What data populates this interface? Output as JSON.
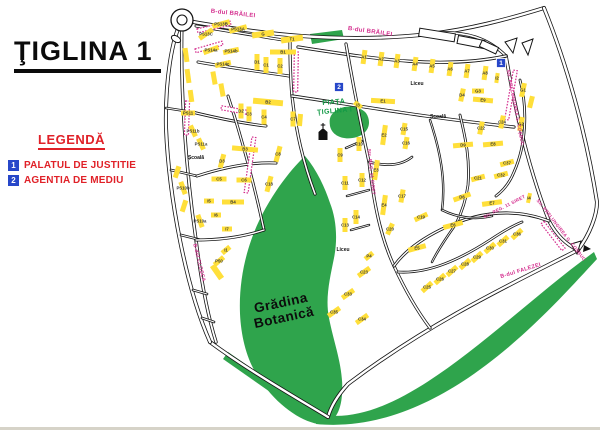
{
  "title": "ŢIGLINA 1",
  "legend": {
    "heading": "LEGENDĂ",
    "items": [
      {
        "num": "1",
        "label": "PALATUL DE JUSTITIE"
      },
      {
        "num": "2",
        "label": "AGENTIA DE MEDIU"
      }
    ]
  },
  "colors": {
    "block_yellow": "#ffdf3a",
    "park_green": "#2fa44c",
    "road_line": "#141414",
    "street_label_pink": "#d42e8e",
    "legend_red": "#e02128",
    "marker_blue": "#2747c9",
    "area_text_green": "#149a46",
    "block_label": "#3a3a3a"
  },
  "map": {
    "street_labels": [
      {
        "t": "B-dul BRĂILEI",
        "x": 233,
        "y": 15,
        "r": 6,
        "s": 6
      },
      {
        "t": "B-dul BRĂILEI",
        "x": 370,
        "y": 33,
        "r": 8,
        "s": 6
      },
      {
        "t": "Str. PRELUNGIREA G. COȘBUC",
        "x": 514,
        "y": 108,
        "r": 79,
        "s": 4.6
      },
      {
        "t": "Str. PRELUNGIREA G. COȘBUC",
        "x": 560,
        "y": 231,
        "r": 52,
        "s": 4.6
      },
      {
        "t": "B-dul FALEZEI",
        "x": 521,
        "y": 272,
        "r": -17,
        "s": 5.5
      },
      {
        "t": "B-dul CLOȘCA",
        "x": 198,
        "y": 263,
        "r": 76,
        "s": 5
      },
      {
        "t": "Str. REG. 11 SIRET",
        "x": 370,
        "y": 172,
        "r": 84,
        "s": 4.6
      },
      {
        "t": "Str. REG. 11 SIRET",
        "x": 505,
        "y": 208,
        "r": -27,
        "s": 4.6
      }
    ],
    "piata": {
      "lines": [
        "PIAŢA",
        "ŢIGLINA I"
      ]
    },
    "gradina": {
      "lines": [
        "Grădina",
        "Botanică"
      ]
    },
    "facility_labels": [
      {
        "t": "Școală",
        "x": 196,
        "y": 159
      },
      {
        "t": "Școală",
        "x": 438,
        "y": 118
      },
      {
        "t": "Liceu",
        "x": 417,
        "y": 85
      },
      {
        "t": "Liceu",
        "x": 343,
        "y": 251
      }
    ],
    "markers": [
      {
        "n": "1",
        "x": 501,
        "y": 63
      },
      {
        "n": "2",
        "x": 339,
        "y": 87
      }
    ],
    "church": {
      "x": 323,
      "y": 133
    },
    "blocks": [
      {
        "l": "PS13B",
        "x": 221,
        "y": 24,
        "w": 18,
        "h": 5,
        "r": -15
      },
      {
        "l": "PS13A",
        "x": 238,
        "y": 29,
        "w": 18,
        "h": 5,
        "r": -15
      },
      {
        "l": "PS13C",
        "x": 206,
        "y": 34,
        "w": 16,
        "h": 5,
        "r": -35
      },
      {
        "l": "PS14a",
        "x": 211,
        "y": 50,
        "w": 16,
        "h": 5,
        "r": -20
      },
      {
        "l": "PS14b",
        "x": 231,
        "y": 51,
        "w": 16,
        "h": 5,
        "r": -12
      },
      {
        "l": "PS14c",
        "x": 223,
        "y": 64,
        "w": 16,
        "h": 5,
        "r": -12
      },
      {
        "l": "G",
        "x": 263,
        "y": 34,
        "w": 22,
        "h": 6,
        "r": -8
      },
      {
        "l": "T1",
        "x": 292,
        "y": 39,
        "w": 22,
        "h": 6,
        "r": -8
      },
      {
        "l": "B1",
        "x": 283,
        "y": 52,
        "w": 26,
        "h": 5,
        "r": 0
      },
      {
        "l": "D1",
        "x": 257,
        "y": 62,
        "w": 5,
        "h": 16,
        "r": 0
      },
      {
        "l": "C1",
        "x": 266,
        "y": 65,
        "w": 5,
        "h": 16,
        "r": 0
      },
      {
        "l": "C2",
        "x": 280,
        "y": 66,
        "w": 5,
        "h": 16,
        "r": 0
      },
      {
        "l": "B2",
        "x": 268,
        "y": 102,
        "w": 30,
        "h": 6,
        "r": 5
      },
      {
        "l": "D2",
        "x": 241,
        "y": 111,
        "w": 5,
        "h": 15,
        "r": 0
      },
      {
        "l": "C3",
        "x": 249,
        "y": 114,
        "w": 5,
        "h": 15,
        "r": 0
      },
      {
        "l": "C4",
        "x": 264,
        "y": 117,
        "w": 5,
        "h": 15,
        "r": 0
      },
      {
        "l": "C7",
        "x": 293,
        "y": 119,
        "w": 5,
        "h": 15,
        "r": 0
      },
      {
        "l": "PS11",
        "x": 188,
        "y": 113,
        "w": 14,
        "h": 5,
        "r": 0
      },
      {
        "l": "PS11b",
        "x": 193,
        "y": 131,
        "w": 5,
        "h": 12,
        "r": -25
      },
      {
        "l": "PS11a",
        "x": 201,
        "y": 144,
        "w": 5,
        "h": 12,
        "r": -25
      },
      {
        "l": "B3",
        "x": 245,
        "y": 149,
        "w": 26,
        "h": 5,
        "r": 5
      },
      {
        "l": "D3",
        "x": 222,
        "y": 161,
        "w": 5,
        "h": 14,
        "r": 15
      },
      {
        "l": "C5",
        "x": 219,
        "y": 179,
        "w": 15,
        "h": 5,
        "r": 0
      },
      {
        "l": "C6",
        "x": 244,
        "y": 180,
        "w": 15,
        "h": 5,
        "r": 0
      },
      {
        "l": "C8",
        "x": 278,
        "y": 154,
        "w": 5,
        "h": 16,
        "r": 15
      },
      {
        "l": "C18",
        "x": 269,
        "y": 184,
        "w": 5,
        "h": 16,
        "r": 15
      },
      {
        "l": "I5",
        "x": 209,
        "y": 201,
        "w": 10,
        "h": 5,
        "r": 0
      },
      {
        "l": "B4",
        "x": 233,
        "y": 202,
        "w": 22,
        "h": 5,
        "r": 0
      },
      {
        "l": "I6",
        "x": 216,
        "y": 215,
        "w": 10,
        "h": 5,
        "r": 0
      },
      {
        "l": "I7",
        "x": 227,
        "y": 229,
        "w": 10,
        "h": 5,
        "r": 0
      },
      {
        "l": "PS10b",
        "x": 183,
        "y": 188,
        "w": 5,
        "h": 13,
        "r": -20
      },
      {
        "l": "PS10a",
        "x": 200,
        "y": 221,
        "w": 5,
        "h": 13,
        "r": -20
      },
      {
        "l": "I1",
        "x": 226,
        "y": 250,
        "w": 10,
        "h": 5,
        "r": -40
      },
      {
        "l": "P50",
        "x": 219,
        "y": 261,
        "w": 12,
        "h": 5,
        "r": -40
      },
      {
        "l": "A1",
        "x": 364,
        "y": 57,
        "w": 5,
        "h": 14,
        "r": 8
      },
      {
        "l": "A2",
        "x": 381,
        "y": 59,
        "w": 5,
        "h": 14,
        "r": 8
      },
      {
        "l": "A3",
        "x": 397,
        "y": 61,
        "w": 5,
        "h": 14,
        "r": 8
      },
      {
        "l": "A4",
        "x": 415,
        "y": 64,
        "w": 5,
        "h": 14,
        "r": 8
      },
      {
        "l": "A5",
        "x": 432,
        "y": 66,
        "w": 5,
        "h": 14,
        "r": 8
      },
      {
        "l": "A6",
        "x": 450,
        "y": 69,
        "w": 5,
        "h": 14,
        "r": 8
      },
      {
        "l": "A7",
        "x": 467,
        "y": 71,
        "w": 5,
        "h": 14,
        "r": 8
      },
      {
        "l": "A8",
        "x": 485,
        "y": 73,
        "w": 5,
        "h": 14,
        "r": 8
      },
      {
        "l": "I2",
        "x": 497,
        "y": 78,
        "w": 4,
        "h": 10,
        "r": 8
      },
      {
        "l": "G3",
        "x": 478,
        "y": 91,
        "w": 12,
        "h": 5,
        "r": 0
      },
      {
        "l": "D4",
        "x": 462,
        "y": 95,
        "w": 5,
        "h": 13,
        "r": 12
      },
      {
        "l": "E9",
        "x": 483,
        "y": 100,
        "w": 20,
        "h": 5,
        "r": 5
      },
      {
        "l": "G1",
        "x": 523,
        "y": 90,
        "w": 5,
        "h": 14,
        "r": 12
      },
      {
        "l": "G2",
        "x": 521,
        "y": 124,
        "w": 5,
        "h": 14,
        "r": 12
      },
      {
        "l": "C24",
        "x": 502,
        "y": 122,
        "w": 5,
        "h": 13,
        "r": 12
      },
      {
        "l": "C22",
        "x": 481,
        "y": 128,
        "w": 5,
        "h": 13,
        "r": 12
      },
      {
        "l": "E1",
        "x": 383,
        "y": 101,
        "w": 24,
        "h": 5,
        "r": 3
      },
      {
        "l": "I3",
        "x": 358,
        "y": 105,
        "w": 9,
        "h": 5,
        "r": 40
      },
      {
        "l": "C15",
        "x": 404,
        "y": 129,
        "w": 5,
        "h": 12,
        "r": 10
      },
      {
        "l": "C16",
        "x": 406,
        "y": 143,
        "w": 5,
        "h": 12,
        "r": 10
      },
      {
        "l": "C17",
        "x": 402,
        "y": 196,
        "w": 5,
        "h": 13,
        "r": 10
      },
      {
        "l": "E2",
        "x": 384,
        "y": 135,
        "w": 5,
        "h": 20,
        "r": 8
      },
      {
        "l": "E3",
        "x": 376,
        "y": 170,
        "w": 5,
        "h": 20,
        "r": 8
      },
      {
        "l": "E4",
        "x": 384,
        "y": 205,
        "w": 5,
        "h": 20,
        "r": 8
      },
      {
        "l": "C20",
        "x": 390,
        "y": 229,
        "w": 5,
        "h": 12,
        "r": 25
      },
      {
        "l": "P4",
        "x": 369,
        "y": 256,
        "w": 10,
        "h": 5,
        "r": -40
      },
      {
        "l": "C9",
        "x": 340,
        "y": 155,
        "w": 5,
        "h": 14,
        "r": 0
      },
      {
        "l": "C10",
        "x": 359,
        "y": 144,
        "w": 5,
        "h": 14,
        "r": 0
      },
      {
        "l": "C11",
        "x": 345,
        "y": 183,
        "w": 5,
        "h": 14,
        "r": 0
      },
      {
        "l": "C12",
        "x": 362,
        "y": 180,
        "w": 5,
        "h": 14,
        "r": 0
      },
      {
        "l": "C13",
        "x": 345,
        "y": 225,
        "w": 5,
        "h": 14,
        "r": 0
      },
      {
        "l": "C14",
        "x": 356,
        "y": 217,
        "w": 5,
        "h": 14,
        "r": 0
      },
      {
        "l": "C23",
        "x": 364,
        "y": 272,
        "w": 14,
        "h": 5,
        "r": -35
      },
      {
        "l": "C33",
        "x": 348,
        "y": 294,
        "w": 14,
        "h": 5,
        "r": -35
      },
      {
        "l": "C35",
        "x": 334,
        "y": 312,
        "w": 14,
        "h": 5,
        "r": -35
      },
      {
        "l": "C34",
        "x": 362,
        "y": 319,
        "w": 14,
        "h": 5,
        "r": -35
      },
      {
        "l": "D9",
        "x": 463,
        "y": 145,
        "w": 20,
        "h": 5,
        "r": -5
      },
      {
        "l": "E8",
        "x": 493,
        "y": 144,
        "w": 20,
        "h": 5,
        "r": -5
      },
      {
        "l": "C37",
        "x": 507,
        "y": 163,
        "w": 14,
        "h": 5,
        "r": -15
      },
      {
        "l": "C32",
        "x": 501,
        "y": 175,
        "w": 14,
        "h": 5,
        "r": -15
      },
      {
        "l": "C21",
        "x": 478,
        "y": 178,
        "w": 14,
        "h": 5,
        "r": -15
      },
      {
        "l": "D6",
        "x": 462,
        "y": 197,
        "w": 18,
        "h": 5,
        "r": -20
      },
      {
        "l": "E7",
        "x": 492,
        "y": 203,
        "w": 20,
        "h": 5,
        "r": -8
      },
      {
        "l": "I4",
        "x": 529,
        "y": 198,
        "w": 4,
        "h": 10,
        "r": 12
      },
      {
        "l": "C19",
        "x": 421,
        "y": 217,
        "w": 14,
        "h": 5,
        "r": -25
      },
      {
        "l": "E6",
        "x": 453,
        "y": 225,
        "w": 20,
        "h": 5,
        "r": -15
      },
      {
        "l": "E5",
        "x": 417,
        "y": 248,
        "w": 18,
        "h": 5,
        "r": -15
      },
      {
        "l": "C36",
        "x": 517,
        "y": 234,
        "w": 13,
        "h": 5,
        "r": -42
      },
      {
        "l": "C31",
        "x": 503,
        "y": 241,
        "w": 13,
        "h": 5,
        "r": -42
      },
      {
        "l": "C30",
        "x": 490,
        "y": 248,
        "w": 13,
        "h": 5,
        "r": -42
      },
      {
        "l": "C29",
        "x": 477,
        "y": 257,
        "w": 13,
        "h": 5,
        "r": -42
      },
      {
        "l": "C28",
        "x": 465,
        "y": 264,
        "w": 13,
        "h": 5,
        "r": -42
      },
      {
        "l": "C27",
        "x": 452,
        "y": 271,
        "w": 13,
        "h": 5,
        "r": -42
      },
      {
        "l": "C26",
        "x": 440,
        "y": 279,
        "w": 13,
        "h": 5,
        "r": -42
      },
      {
        "l": "C25",
        "x": 427,
        "y": 287,
        "w": 13,
        "h": 5,
        "r": -42
      }
    ],
    "deco_bars": [
      {
        "x": 186,
        "y": 55,
        "w": 5,
        "h": 14,
        "r": -8
      },
      {
        "x": 188,
        "y": 76,
        "w": 5,
        "h": 14,
        "r": -8
      },
      {
        "x": 191,
        "y": 96,
        "w": 5,
        "h": 12,
        "r": -8
      },
      {
        "x": 214,
        "y": 78,
        "w": 5,
        "h": 13,
        "r": -10
      },
      {
        "x": 222,
        "y": 90,
        "w": 5,
        "h": 13,
        "r": -10
      },
      {
        "x": 177,
        "y": 172,
        "w": 5,
        "h": 12,
        "r": 18
      },
      {
        "x": 184,
        "y": 206,
        "w": 5,
        "h": 12,
        "r": 18
      },
      {
        "x": 217,
        "y": 272,
        "w": 6,
        "h": 16,
        "r": -35
      },
      {
        "x": 531,
        "y": 102,
        "w": 5,
        "h": 12,
        "r": 14
      },
      {
        "x": 300,
        "y": 120,
        "w": 5,
        "h": 12,
        "r": 5
      }
    ]
  }
}
